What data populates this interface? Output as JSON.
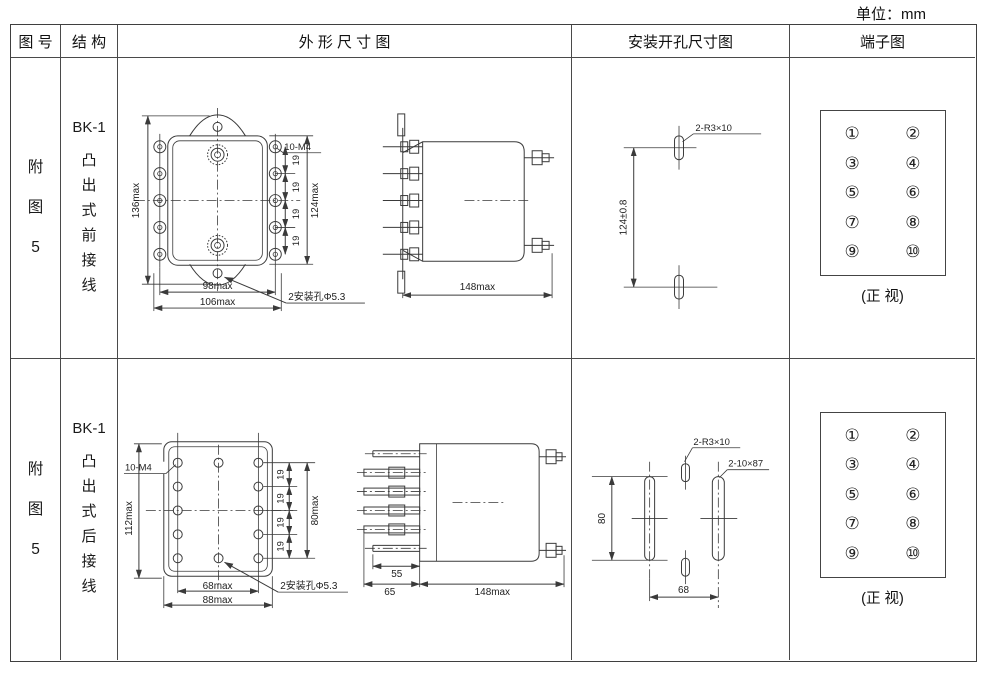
{
  "page": {
    "unit_label": "单位：mm"
  },
  "table": {
    "headers": {
      "fig_no": "图 号",
      "structure": "结 构",
      "outline": "外  形  尺  寸  图",
      "mounting": "安装开孔尺寸图",
      "terminal": "端子图"
    }
  },
  "rows": [
    {
      "fig_no": "附图5",
      "model": "BK-1",
      "structure": "凸出式前接线",
      "outline": {
        "total_height": "136max",
        "screw_spec": "10-M4",
        "pitch": "19",
        "terminal_height": "124max",
        "width_inner": "98max",
        "width_outer": "106max",
        "mount_hole_note": "2安装孔Φ5.3",
        "depth": "148max"
      },
      "mounting": {
        "slot_spec": "2-R3×10",
        "vertical_span": "124±0.8"
      },
      "terminal": {
        "left": [
          "①",
          "③",
          "⑤",
          "⑦",
          "⑨"
        ],
        "right": [
          "②",
          "④",
          "⑥",
          "⑧",
          "⑩"
        ],
        "caption": "(正 视)"
      }
    },
    {
      "fig_no": "附图5",
      "model": "BK-1",
      "structure": "凸出式后接线",
      "outline": {
        "screw_spec": "10-M4",
        "total_height": "112max",
        "pitch": "19",
        "terminal_height": "80max",
        "width_inner": "68max",
        "width_outer": "88max",
        "mount_hole_note": "2安装孔Φ5.3",
        "stud_length": "55",
        "front_depth": "65",
        "depth": "148max"
      },
      "mounting": {
        "small_slot_spec": "2-R3×10",
        "long_slot_spec": "2-10×87",
        "vertical_span": "80",
        "horizontal_span": "68"
      },
      "terminal": {
        "left": [
          "①",
          "③",
          "⑤",
          "⑦",
          "⑨"
        ],
        "right": [
          "②",
          "④",
          "⑥",
          "⑧",
          "⑩"
        ],
        "caption": "(正 视)"
      }
    }
  ]
}
